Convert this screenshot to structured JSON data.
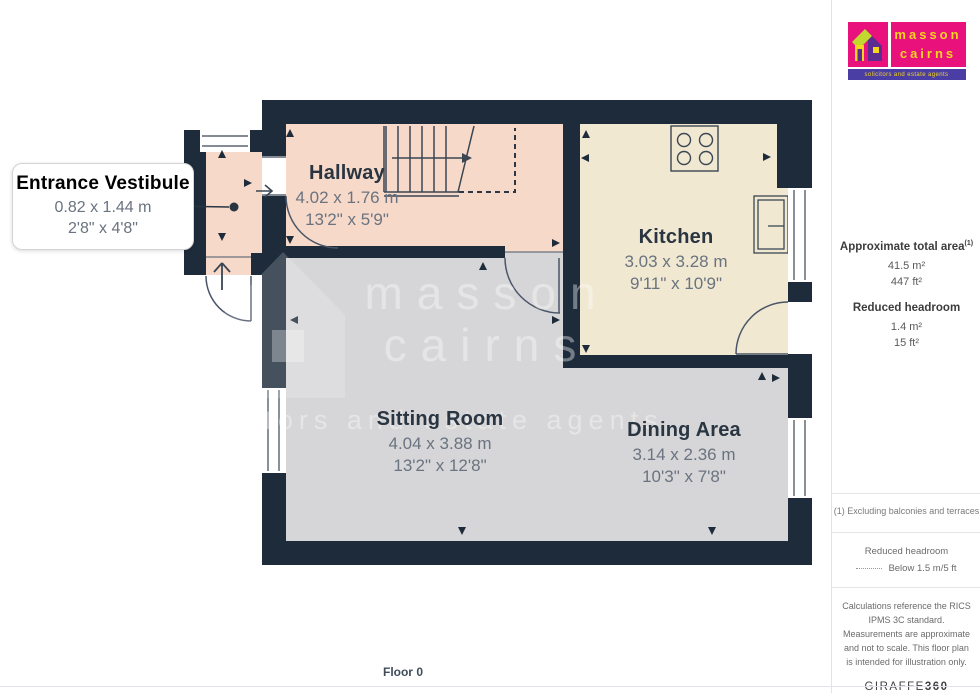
{
  "branding": {
    "logo_line1": "masson",
    "logo_line2": "cairns",
    "tagline": "solicitors and estate agents",
    "colors": {
      "pink": "#e9117c",
      "strip": "#4a3ea5",
      "yellow": "#f5d51d",
      "lime": "#c3d82e",
      "purple": "#5c2d91"
    }
  },
  "watermark": {
    "line1": "masson",
    "line2": "cairns",
    "line3": "solicitors and estate agents"
  },
  "floorplan": {
    "floor_label": "Floor 0",
    "wall_color": "#1e2b3b",
    "floor_colors": {
      "hall": "#f6d9c9",
      "kitchen": "#f0e8d1",
      "living": "#d6d6d8"
    },
    "rooms": [
      {
        "id": "entrance-vestibule",
        "name": "Entrance Vestibule",
        "metric": "0.82 x 1.44 m",
        "imperial": "2'8\" x 4'8\""
      },
      {
        "id": "hallway",
        "name": "Hallway",
        "metric": "4.02 x 1.76 m",
        "imperial": "13'2\" x 5'9\""
      },
      {
        "id": "kitchen",
        "name": "Kitchen",
        "metric": "3.03 x 3.28 m",
        "imperial": "9'11\" x 10'9\""
      },
      {
        "id": "sitting-room",
        "name": "Sitting Room",
        "metric": "4.04 x 3.88 m",
        "imperial": "13'2\" x 12'8\""
      },
      {
        "id": "dining-area",
        "name": "Dining Area",
        "metric": "3.14 x 2.36 m",
        "imperial": "10'3\" x 7'8\""
      }
    ]
  },
  "sidebar": {
    "area_title": "Approximate total area",
    "area_title_sup": "(1)",
    "area_m2": "41.5 m²",
    "area_ft2": "447 ft²",
    "headroom_title": "Reduced headroom",
    "headroom_m2": "1.4 m²",
    "headroom_ft2": "15 ft²",
    "note": "(1) Excluding balconies and terraces",
    "legend_title": "Reduced headroom",
    "legend_value": "Below 1.5 m/5 ft",
    "disclaimer": "Calculations reference the RICS IPMS 3C standard. Measurements are approximate and not to scale. This floor plan is intended for illustration only.",
    "brand_name": "GIRAFFE",
    "brand_suffix": "360"
  }
}
